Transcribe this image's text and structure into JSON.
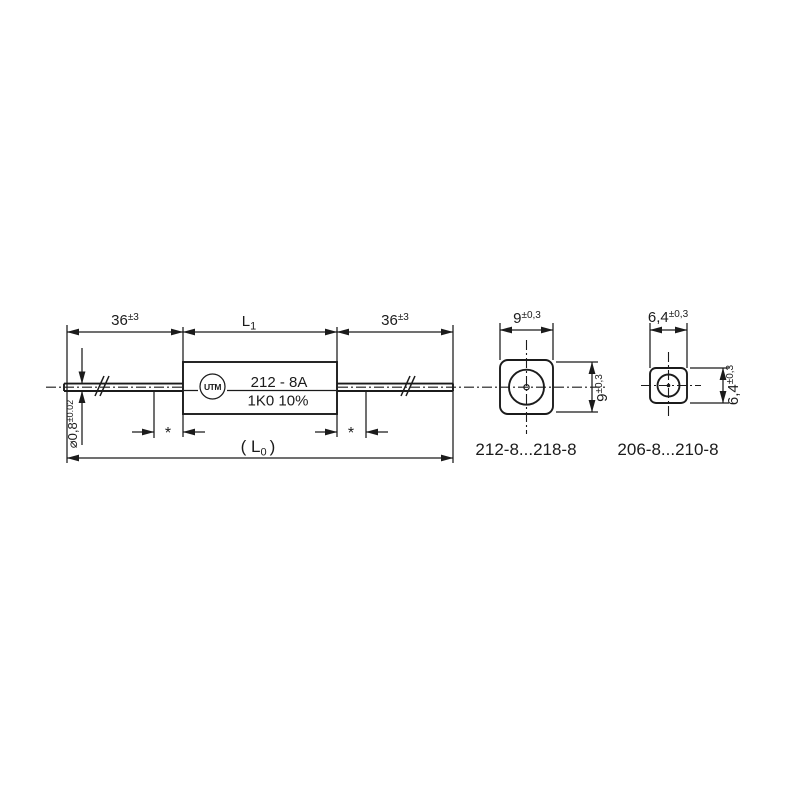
{
  "drawing": {
    "colors": {
      "line": "#1b1b1b",
      "background": "#ffffff"
    },
    "main_view": {
      "dim_lead_left": {
        "value": "36",
        "tol": "±3"
      },
      "dim_body": {
        "base": "L",
        "sub": "1"
      },
      "dim_lead_right": {
        "value": "36",
        "tol": "±3"
      },
      "dim_overall": {
        "pre": "( L",
        "sub": "0",
        "post": ")"
      },
      "dim_wire_diameter": {
        "value": "⌀0,8",
        "tol": "±0.02"
      },
      "asterisk": "*",
      "body_marking": {
        "line1": "212 - 8A",
        "line2": "1K0 10%"
      },
      "logo_text": "UTM"
    },
    "end_view_large": {
      "dim_width": {
        "value": "9",
        "tol": "±0,3"
      },
      "dim_height": {
        "value": "9",
        "tol": "±0,3"
      },
      "caption": "212-8...218-8"
    },
    "end_view_small": {
      "dim_width": {
        "value": "6,4",
        "tol": "±0,3"
      },
      "dim_height": {
        "value": "6,4",
        "tol": "±0,3"
      },
      "caption": "206-8...210-8"
    }
  }
}
